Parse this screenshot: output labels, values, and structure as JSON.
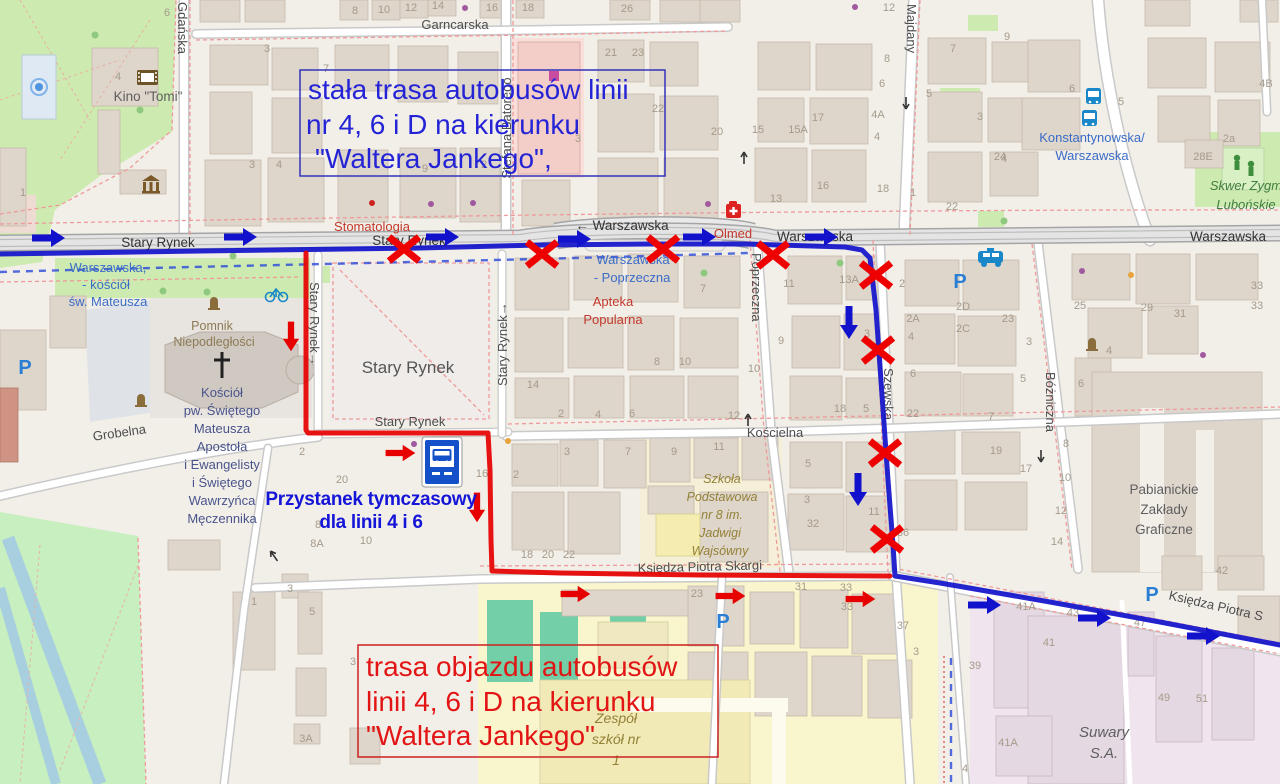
{
  "map": {
    "streets": {
      "garncarska": "Garncarska",
      "gdanska": "Gdańska",
      "stefana_batorego": "Stefana Batorego",
      "majdany": "Majdany",
      "warszawska": "Warszawska",
      "warszawska_westbound": "← Warszawska",
      "stary_rynek": "Stary Rynek",
      "stary_rynek_oneway": "Stary Rynek→",
      "poprzeczna": "Poprzeczna",
      "szewska": "Szewska",
      "bozniczna": "Bóżniczna",
      "koscielna": "Kościelna",
      "grobelna": "Grobelna",
      "ksiedza_piotra_skargi": "Księdza Piotra Skargi",
      "ksiedza_piotra_s": "Księdza Piotra S"
    },
    "square_name": "Stary Rynek",
    "pois": {
      "kino": "Kino \"Tomi\"",
      "stomatologia": "Stomatologia",
      "olmed": "Olmed",
      "apteka": [
        "Apteka",
        "Popularna"
      ],
      "pomnik": [
        "Pomnik",
        "Niepodległości"
      ],
      "kosciol": [
        "Kościół",
        "pw. Świętego",
        "Mateusza",
        "Apostoła",
        "i Ewangelisty",
        "i Świętego",
        "Wawrzyńca",
        "Męczennika"
      ],
      "szkola8": [
        "Szkoła",
        "Podstawowa",
        "nr 8 im.",
        "Jadwigi",
        "Wajsówny"
      ],
      "pzg": [
        "Pabianickie",
        "Zakłady",
        "Graficzne"
      ],
      "suwary": [
        "Suwary",
        "S.A."
      ],
      "zespol": [
        "Zespół",
        "szkół nr",
        "1"
      ],
      "skwer": [
        "Skwer Zygm",
        "Lubońskie"
      ]
    },
    "bus_stops": {
      "warszawska_kosciol": [
        "Warszawska,",
        "- kościół",
        "św. Mateusza"
      ],
      "warszawska_poprzeczna": [
        "Warszawska",
        "- Poprzeczna"
      ],
      "konstantynowska_warszawska": [
        "Konstantynowska/",
        "Warszawska"
      ]
    },
    "parking_symbol": "P",
    "house_numbers": [
      {
        "t": "8",
        "x": 355,
        "y": 14
      },
      {
        "t": "10",
        "x": 384,
        "y": 13
      },
      {
        "t": "12",
        "x": 411,
        "y": 11
      },
      {
        "t": "14",
        "x": 438,
        "y": 9
      },
      {
        "t": "16",
        "x": 492,
        "y": 11
      },
      {
        "t": "18",
        "x": 528,
        "y": 11
      },
      {
        "t": "26",
        "x": 627,
        "y": 12
      },
      {
        "t": "21",
        "x": 611,
        "y": 56
      },
      {
        "t": "23",
        "x": 638,
        "y": 56
      },
      {
        "t": "6",
        "x": 167,
        "y": 16
      },
      {
        "t": "4",
        "x": 118,
        "y": 80
      },
      {
        "t": "1",
        "x": 23,
        "y": 196
      },
      {
        "t": "3",
        "x": 267,
        "y": 52
      },
      {
        "t": "3",
        "x": 252,
        "y": 168
      },
      {
        "t": "4",
        "x": 279,
        "y": 168
      },
      {
        "t": "7",
        "x": 326,
        "y": 72
      },
      {
        "t": "9",
        "x": 425,
        "y": 172
      },
      {
        "t": "2",
        "x": 484,
        "y": 168
      },
      {
        "t": "3",
        "x": 578,
        "y": 142
      },
      {
        "t": "22",
        "x": 658,
        "y": 112
      },
      {
        "t": "20",
        "x": 717,
        "y": 135
      },
      {
        "t": "15",
        "x": 758,
        "y": 133
      },
      {
        "t": "15A",
        "x": 798,
        "y": 133
      },
      {
        "t": "17",
        "x": 818,
        "y": 121
      },
      {
        "t": "13",
        "x": 776,
        "y": 202
      },
      {
        "t": "16",
        "x": 823,
        "y": 189
      },
      {
        "t": "18",
        "x": 883,
        "y": 192
      },
      {
        "t": "12",
        "x": 889,
        "y": 11
      },
      {
        "t": "8",
        "x": 887,
        "y": 62
      },
      {
        "t": "6",
        "x": 882,
        "y": 87
      },
      {
        "t": "4A",
        "x": 878,
        "y": 118
      },
      {
        "t": "4",
        "x": 877,
        "y": 140
      },
      {
        "t": "5",
        "x": 929,
        "y": 97
      },
      {
        "t": "7",
        "x": 953,
        "y": 52
      },
      {
        "t": "3",
        "x": 980,
        "y": 120
      },
      {
        "t": "24",
        "x": 1000,
        "y": 160
      },
      {
        "t": "22",
        "x": 952,
        "y": 210
      },
      {
        "t": "1",
        "x": 913,
        "y": 196
      },
      {
        "t": "9",
        "x": 1007,
        "y": 40
      },
      {
        "t": "6",
        "x": 1072,
        "y": 92
      },
      {
        "t": "5",
        "x": 1121,
        "y": 105
      },
      {
        "t": "4",
        "x": 1004,
        "y": 162
      },
      {
        "t": "4B",
        "x": 1266,
        "y": 87
      },
      {
        "t": "2a",
        "x": 1229,
        "y": 142
      },
      {
        "t": "28E",
        "x": 1203,
        "y": 160
      },
      {
        "t": "13A",
        "x": 849,
        "y": 283
      },
      {
        "t": "11",
        "x": 789,
        "y": 287
      },
      {
        "t": "2",
        "x": 902,
        "y": 287
      },
      {
        "t": "2D",
        "x": 963,
        "y": 310
      },
      {
        "t": "2A",
        "x": 913,
        "y": 322
      },
      {
        "t": "2C",
        "x": 963,
        "y": 332
      },
      {
        "t": "23",
        "x": 1008,
        "y": 322
      },
      {
        "t": "3",
        "x": 1029,
        "y": 345
      },
      {
        "t": "5",
        "x": 1023,
        "y": 382
      },
      {
        "t": "4",
        "x": 911,
        "y": 340
      },
      {
        "t": "6",
        "x": 913,
        "y": 377
      },
      {
        "t": "22",
        "x": 913,
        "y": 417
      },
      {
        "t": "18",
        "x": 840,
        "y": 412
      },
      {
        "t": "5",
        "x": 866,
        "y": 412
      },
      {
        "t": "3",
        "x": 867,
        "y": 337
      },
      {
        "t": "7",
        "x": 991,
        "y": 420
      },
      {
        "t": "19",
        "x": 996,
        "y": 454
      },
      {
        "t": "17",
        "x": 1026,
        "y": 472
      },
      {
        "t": "25",
        "x": 1080,
        "y": 309
      },
      {
        "t": "29",
        "x": 1147,
        "y": 311
      },
      {
        "t": "31",
        "x": 1180,
        "y": 317
      },
      {
        "t": "33",
        "x": 1257,
        "y": 289
      },
      {
        "t": "33",
        "x": 1257,
        "y": 309
      },
      {
        "t": "4",
        "x": 1109,
        "y": 354
      },
      {
        "t": "6",
        "x": 1081,
        "y": 387
      },
      {
        "t": "8",
        "x": 1066,
        "y": 447
      },
      {
        "t": "10",
        "x": 1065,
        "y": 481
      },
      {
        "t": "12",
        "x": 1061,
        "y": 514
      },
      {
        "t": "14",
        "x": 1057,
        "y": 545
      },
      {
        "t": "7",
        "x": 703,
        "y": 292
      },
      {
        "t": "8",
        "x": 657,
        "y": 365
      },
      {
        "t": "10",
        "x": 685,
        "y": 365
      },
      {
        "t": "14",
        "x": 533,
        "y": 388
      },
      {
        "t": "9",
        "x": 781,
        "y": 344
      },
      {
        "t": "10",
        "x": 754,
        "y": 372
      },
      {
        "t": "2",
        "x": 561,
        "y": 417
      },
      {
        "t": "4",
        "x": 598,
        "y": 418
      },
      {
        "t": "6",
        "x": 632,
        "y": 417
      },
      {
        "t": "12",
        "x": 734,
        "y": 419
      },
      {
        "t": "3",
        "x": 567,
        "y": 455
      },
      {
        "t": "7",
        "x": 628,
        "y": 455
      },
      {
        "t": "9",
        "x": 674,
        "y": 455
      },
      {
        "t": "11",
        "x": 719,
        "y": 450
      },
      {
        "t": "5",
        "x": 808,
        "y": 467
      },
      {
        "t": "3",
        "x": 807,
        "y": 503
      },
      {
        "t": "32",
        "x": 813,
        "y": 527
      },
      {
        "t": "11",
        "x": 874,
        "y": 515
      },
      {
        "t": "36",
        "x": 903,
        "y": 536
      },
      {
        "t": "2",
        "x": 302,
        "y": 455
      },
      {
        "t": "20",
        "x": 342,
        "y": 483
      },
      {
        "t": "8",
        "x": 318,
        "y": 528
      },
      {
        "t": "8A",
        "x": 317,
        "y": 547
      },
      {
        "t": "10",
        "x": 366,
        "y": 544
      },
      {
        "t": "16",
        "x": 482,
        "y": 477
      },
      {
        "t": "2",
        "x": 516,
        "y": 478
      },
      {
        "t": "18",
        "x": 527,
        "y": 558
      },
      {
        "t": "20",
        "x": 548,
        "y": 558
      },
      {
        "t": "22",
        "x": 569,
        "y": 558
      },
      {
        "t": "23",
        "x": 697,
        "y": 597
      },
      {
        "t": "31",
        "x": 801,
        "y": 590
      },
      {
        "t": "33",
        "x": 846,
        "y": 591
      },
      {
        "t": "33",
        "x": 847,
        "y": 610
      },
      {
        "t": "37",
        "x": 903,
        "y": 629
      },
      {
        "t": "3",
        "x": 916,
        "y": 655
      },
      {
        "t": "1",
        "x": 254,
        "y": 605
      },
      {
        "t": "3",
        "x": 290,
        "y": 592
      },
      {
        "t": "5",
        "x": 312,
        "y": 615
      },
      {
        "t": "3A",
        "x": 306,
        "y": 742
      },
      {
        "t": "3",
        "x": 353,
        "y": 665
      },
      {
        "t": "42",
        "x": 1222,
        "y": 574
      },
      {
        "t": "41A",
        "x": 1026,
        "y": 610
      },
      {
        "t": "43",
        "x": 1073,
        "y": 616
      },
      {
        "t": "45",
        "x": 1102,
        "y": 619
      },
      {
        "t": "47",
        "x": 1140,
        "y": 626
      },
      {
        "t": "41",
        "x": 1049,
        "y": 646
      },
      {
        "t": "39",
        "x": 975,
        "y": 669
      },
      {
        "t": "49",
        "x": 1164,
        "y": 701
      },
      {
        "t": "51",
        "x": 1202,
        "y": 702
      },
      {
        "t": "41A",
        "x": 1008,
        "y": 746
      },
      {
        "t": "4",
        "x": 965,
        "y": 772
      }
    ]
  },
  "annotations": {
    "fixed_route_note": {
      "lines": [
        "stała trasa autobusów linii",
        "nr 4, 6 i D na kierunku",
        "\"Waltera Jankego\","
      ]
    },
    "detour_note": {
      "lines": [
        "trasa objazdu autobusów",
        "linii 4, 6 i D na kierunku",
        "\"Waltera Jankego\""
      ]
    },
    "temp_stop_note": {
      "lines": [
        "Przystanek tymczasowy",
        "dla linii 4 i 6"
      ]
    },
    "colors": {
      "fixed_route": "#1212cc",
      "detour_route": "#e60000"
    }
  }
}
